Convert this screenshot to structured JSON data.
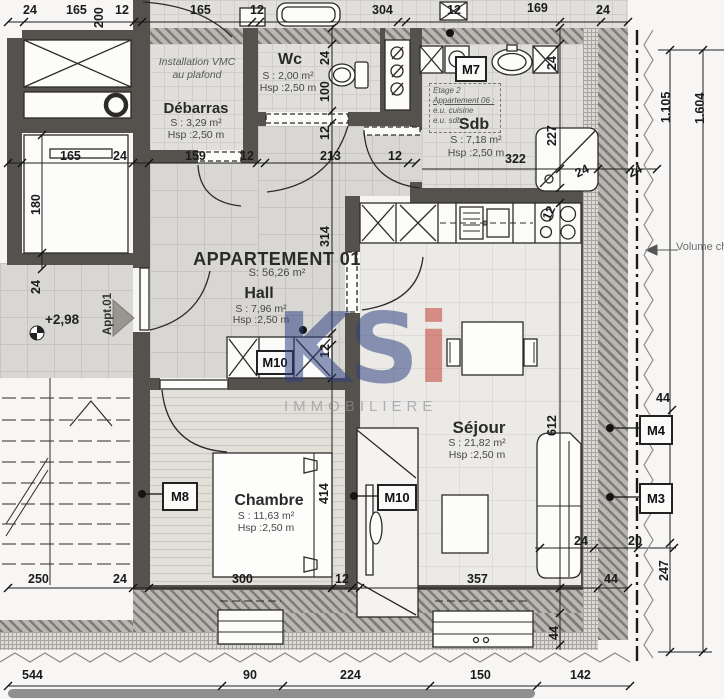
{
  "apartment": {
    "title": "APPARTEMENT 01",
    "area": "S: 56,26 m²"
  },
  "rooms": {
    "debarras": {
      "name": "Débarras",
      "area": "S : 3,29 m²",
      "height": "Hsp :2,50 m"
    },
    "wc": {
      "name": "Wc",
      "area": "S : 2,00 m²",
      "height": "Hsp :2,50 m"
    },
    "sdb": {
      "name": "Sdb",
      "area": "S : 7,18 m²",
      "height": "Hsp :2,50 m"
    },
    "hall": {
      "name": "Hall",
      "area": "S : 7,96 m²",
      "height": "Hsp :2,50 m"
    },
    "sejour": {
      "name": "Séjour",
      "area": "S : 21,82 m²",
      "height": "Hsp :2,50 m"
    },
    "chambre": {
      "name": "Chambre",
      "area": "S : 11,63 m²",
      "height": "Hsp :2,50 m"
    }
  },
  "annotations": {
    "vmc_line1": "Installation VMC",
    "vmc_line2": "au plafond",
    "level": "+2,98",
    "entrance": "Appt.01",
    "volume": "Volume cha",
    "etage": [
      "Etage 2",
      "Appartement 06 :",
      "e.u. cuisine",
      "e.u. sdb"
    ]
  },
  "markers": {
    "m7": "M7",
    "m8": "M8",
    "m10_hall": "M10",
    "m10_chambre": "M10",
    "m4": "M4",
    "m3": "M3"
  },
  "dims": {
    "top": [
      "24",
      "165",
      "12",
      "165",
      "12",
      "304",
      "12",
      "169",
      "24"
    ],
    "top_v": "200",
    "mid": [
      "165",
      "24",
      "159",
      "12",
      "213",
      "12"
    ],
    "sdb": [
      "322",
      "24",
      "24"
    ],
    "sdb_v": [
      "24",
      "227"
    ],
    "wc_v": [
      "24",
      "100",
      "12"
    ],
    "hall_v": [
      "314",
      "12"
    ],
    "kitchen_v": "12",
    "sejour_v": "612",
    "chambre_v": "414",
    "room_v": [
      "180",
      "24"
    ],
    "bottom1": [
      "250",
      "24",
      "300",
      "12",
      "357",
      "44"
    ],
    "bottom1_v": "44",
    "bottom2": [
      "544",
      "90",
      "224",
      "150",
      "142"
    ],
    "right": [
      "1.105",
      "1.604",
      "44",
      "24",
      "20",
      "247"
    ]
  },
  "watermark": {
    "text_k": "K",
    "text_s": "S",
    "text_i": "i",
    "subtitle": "IMMOBILIERE"
  },
  "colors": {
    "watermark_navy": "#2e3f7e",
    "watermark_red": "#c23a2f",
    "wall": "#55524e"
  }
}
